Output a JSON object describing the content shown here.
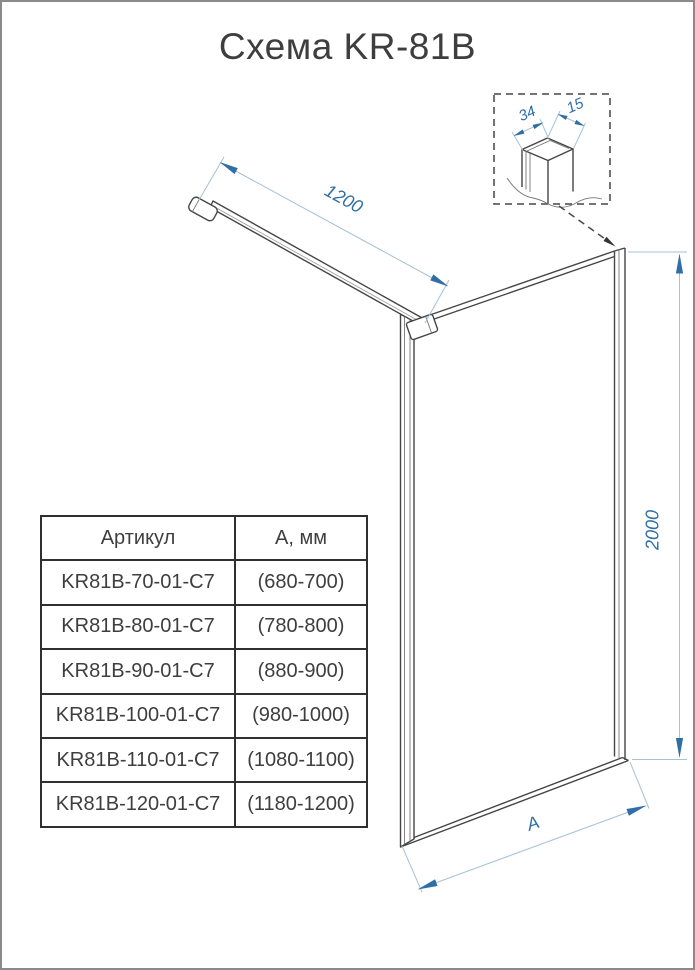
{
  "title": "Схема KR-81B",
  "diagram": {
    "dims": {
      "bar": "1200",
      "height": "2000",
      "width": "A",
      "profile": "34",
      "glass": "15"
    }
  },
  "table": {
    "col_article": "Артикул",
    "col_width": "А, мм",
    "rows": [
      {
        "article": "KR81B-70-01-C7",
        "width": "(680-700)"
      },
      {
        "article": "KR81B-80-01-C7",
        "width": "(780-800)"
      },
      {
        "article": "KR81B-90-01-C7",
        "width": "(880-900)"
      },
      {
        "article": "KR81B-100-01-C7",
        "width": "(980-1000)"
      },
      {
        "article": "KR81B-110-01-C7",
        "width": "(1080-1100)"
      },
      {
        "article": "KR81B-120-01-C7",
        "width": "(1180-1200)"
      }
    ]
  },
  "theme": {
    "dim-blue": "#2f6ea6",
    "dim-light": "#a6c1d8",
    "line-dark": "#454545",
    "text-dark": "#3e3e3e"
  }
}
